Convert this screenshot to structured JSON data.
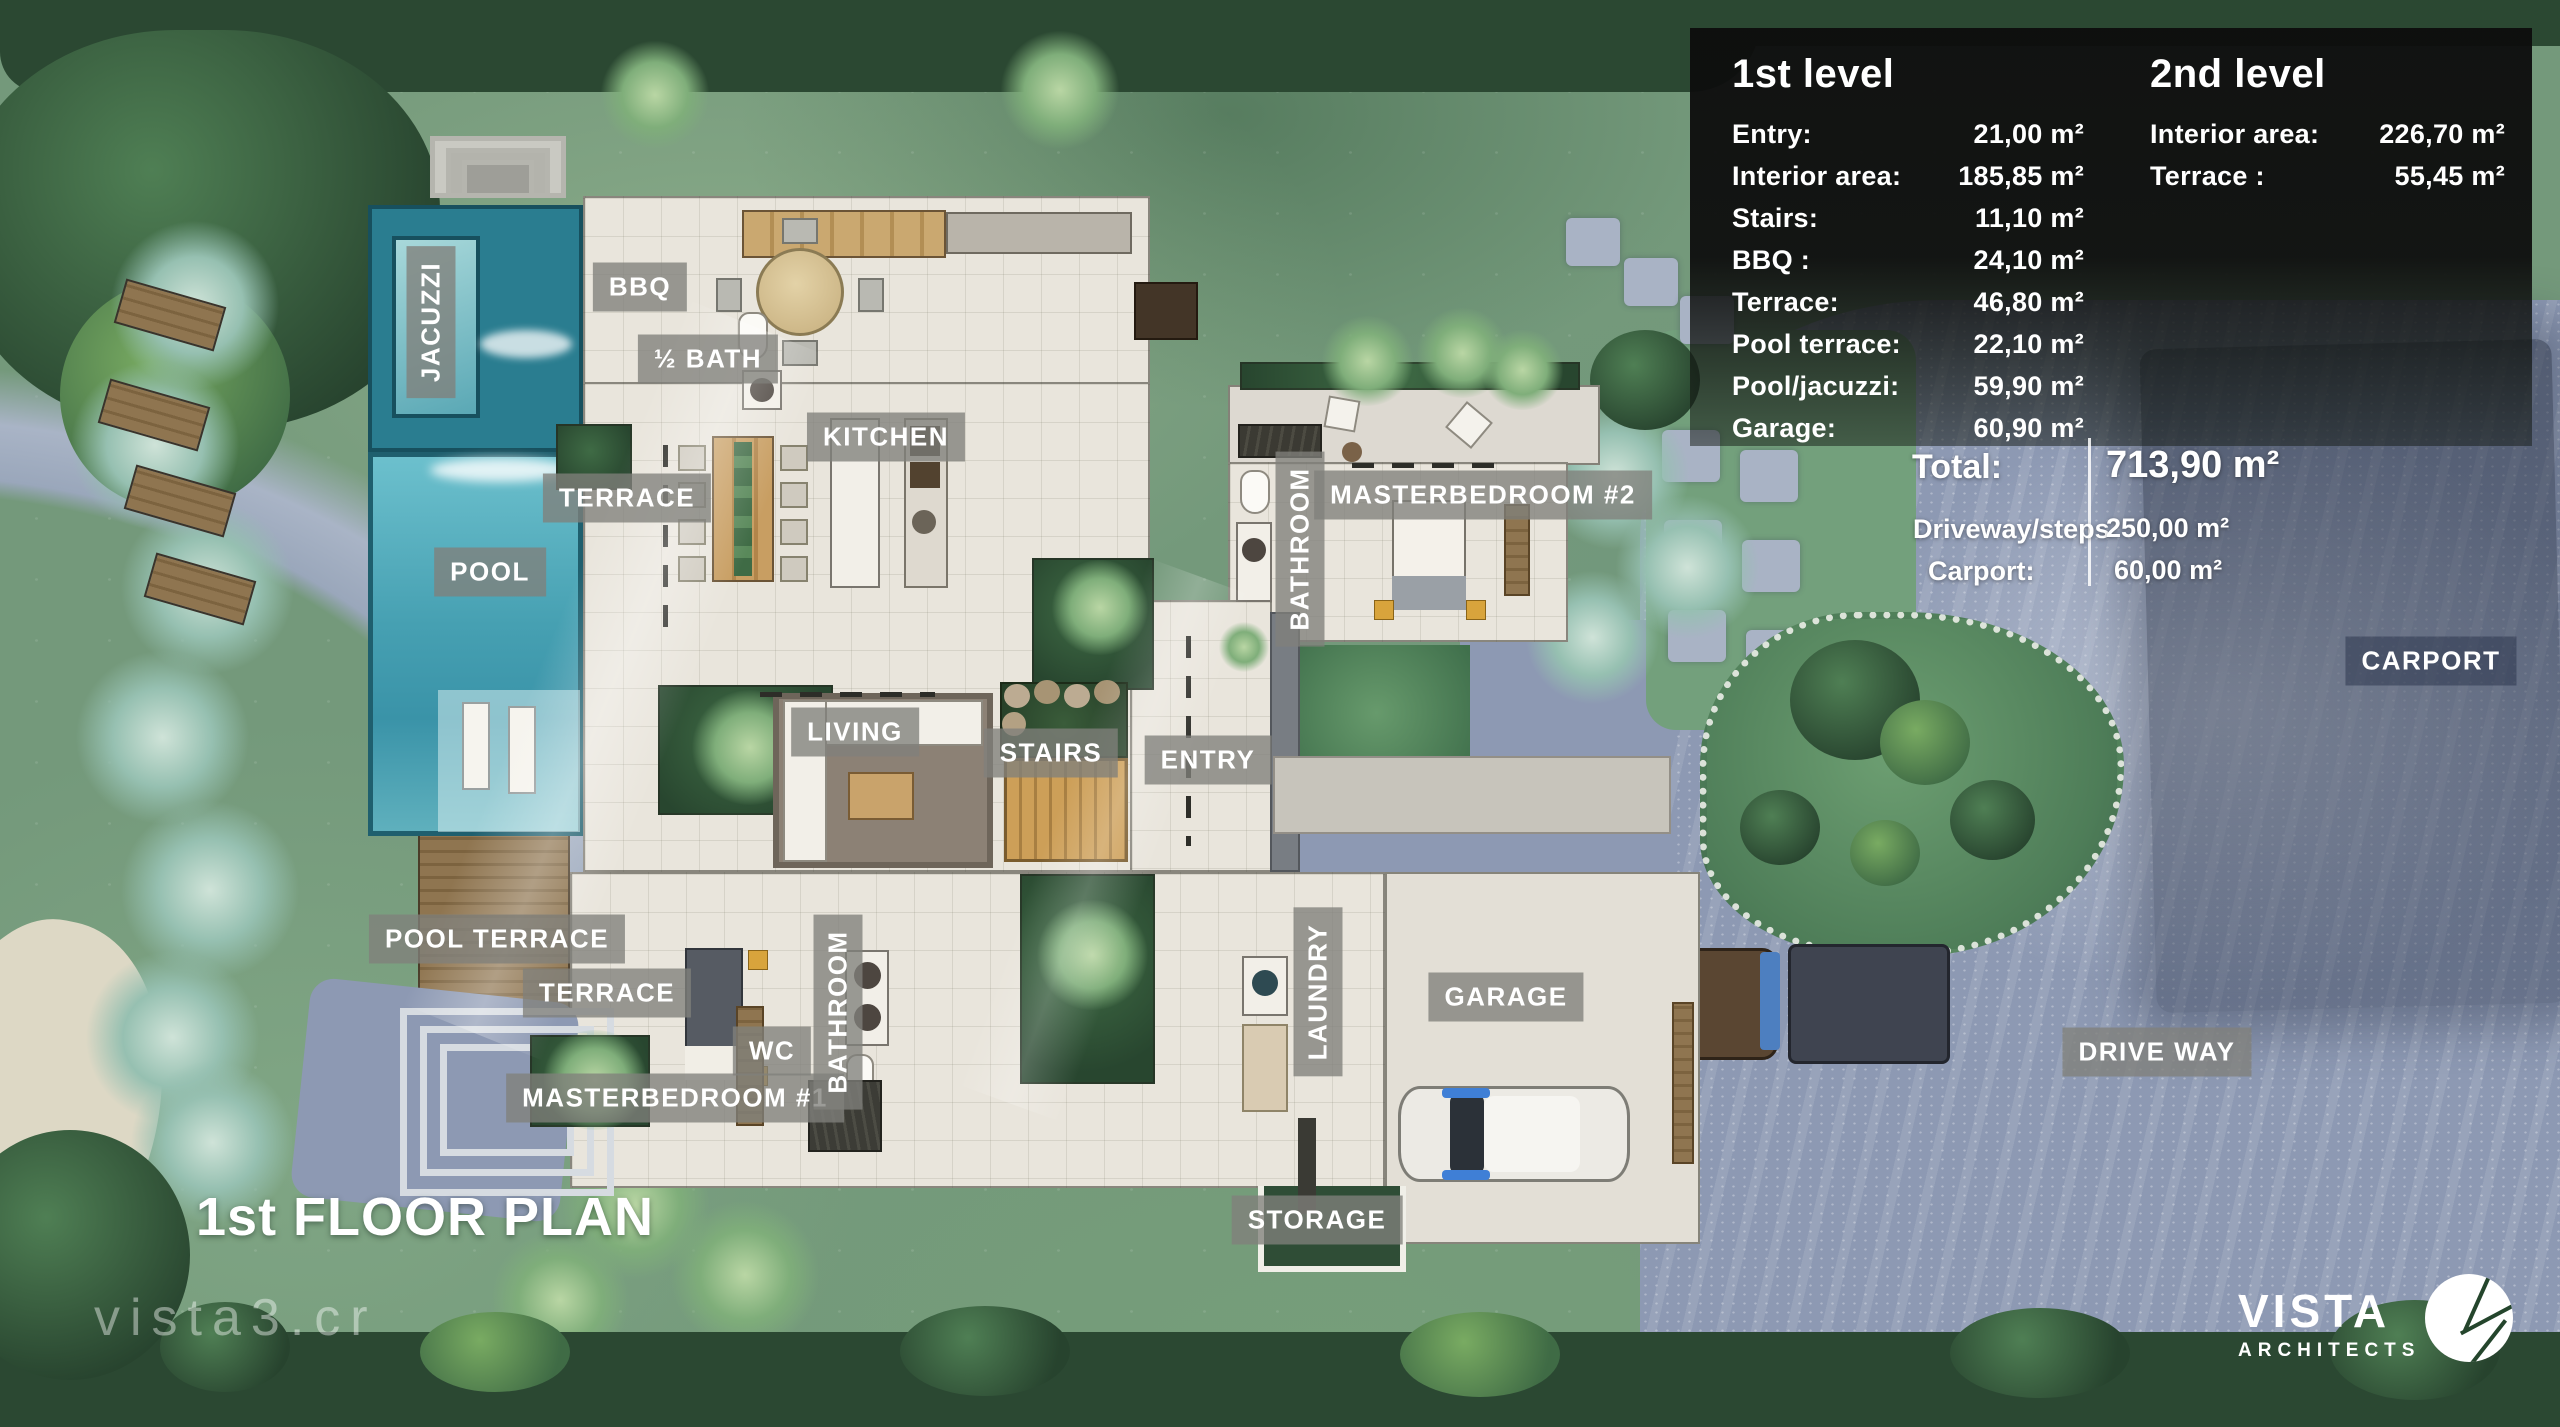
{
  "title": "1st FLOOR PLAN",
  "watermark": "vista3.cr",
  "logo": {
    "name": "VISTA",
    "sub": "ARCHITECTS"
  },
  "rooms": {
    "jacuzzi": "JACUZZI",
    "bbq": "BBQ",
    "half_bath": "½ BATH",
    "kitchen": "KITCHEN",
    "terrace_upper": "TERRACE",
    "pool": "POOL",
    "living": "LIVING",
    "stairs": "STAIRS",
    "entry": "ENTRY",
    "bathroom_2": "BATHROOM",
    "masterbedroom_2": "MASTERBEDROOM #2",
    "pool_terrace": "POOL TERRACE",
    "terrace_lower": "TERRACE",
    "wc": "WC",
    "masterbedroom_1": "MASTERBEDROOM #1",
    "bathroom_1": "BATHROOM",
    "laundry": "LAUNDRY",
    "garage": "GARAGE",
    "storage": "STORAGE",
    "drive_way": "DRIVE WAY",
    "carport": "CARPORT"
  },
  "panel": {
    "level1": {
      "title": "1st level",
      "rows": [
        {
          "label": "Entry:",
          "value": "21,00 m²"
        },
        {
          "label": "Interior area:",
          "value": "185,85 m²"
        },
        {
          "label": "Stairs:",
          "value": "11,10 m²"
        },
        {
          "label": "BBQ :",
          "value": "24,10 m²"
        },
        {
          "label": "Terrace:",
          "value": "46,80 m²"
        },
        {
          "label": "Pool terrace:",
          "value": "22,10 m²"
        },
        {
          "label": "Pool/jacuzzi:",
          "value": "59,90 m²"
        },
        {
          "label": "Garage:",
          "value": "60,90 m²"
        }
      ]
    },
    "level2": {
      "title": "2nd level",
      "rows": [
        {
          "label": "Interior area:",
          "value": "226,70 m²"
        },
        {
          "label": "Terrace :",
          "value": "55,45 m²"
        }
      ]
    },
    "total": {
      "label": "Total:",
      "value": "713,90 m²",
      "rows": [
        {
          "label": "Driveway/steps",
          "value": "250,00 m²"
        },
        {
          "label": "Carport:",
          "value": "60,00 m²"
        }
      ]
    }
  },
  "colors": {
    "grass": "#74997b",
    "driveway": "#8d99b3",
    "pool_water": "#4da4b6",
    "panel_bg": "#0d0d0d",
    "label_chip": "#80807b",
    "wood_deck": "#8f7550"
  }
}
